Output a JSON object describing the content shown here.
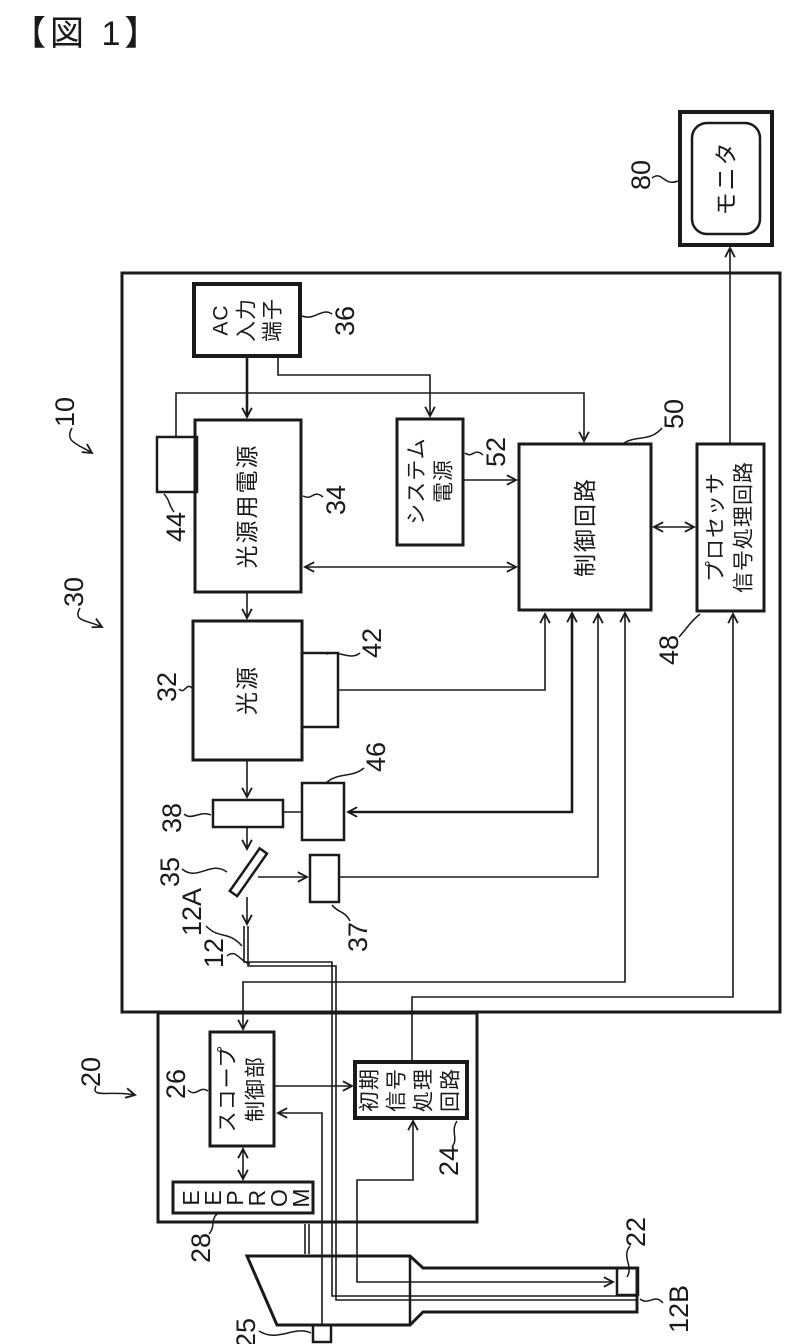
{
  "figure_title": "【図 1】",
  "colors": {
    "ink": "#1a1a1a",
    "background": "#ffffff"
  },
  "blocks": {
    "monitor": {
      "label": "モニタ",
      "ref": "80"
    },
    "ac_input_terminal": {
      "line1": "AC",
      "line2": "入力",
      "line3": "端子",
      "ref": "36"
    },
    "light_source_power_supply": {
      "label": "光源用電源",
      "ref": "34"
    },
    "power_inlet": {
      "ref": "44"
    },
    "system_power_supply": {
      "line1": "システム",
      "line2": "電源",
      "ref": "52"
    },
    "control_circuit": {
      "label": "制御回路",
      "ref": "50"
    },
    "processor_signal_circuit": {
      "line1": "プロセッサ",
      "line2": "信号処理回路",
      "ref": "48"
    },
    "light_source": {
      "label": "光源",
      "ref": "32"
    },
    "sensor_42": {
      "ref": "42"
    },
    "filter_38": {
      "ref": "38"
    },
    "diaphragm_46": {
      "ref": "46"
    },
    "mirror_35": {
      "ref": "35"
    },
    "detector_37": {
      "ref": "37"
    },
    "scope_controller": {
      "line1": "スコープ",
      "line2": "制御部",
      "ref": "26"
    },
    "eeprom": {
      "l1": "E",
      "l2": "E",
      "l3": "P",
      "l4": "R",
      "l5": "O",
      "l6": "M",
      "ref": "28"
    },
    "initial_signal_circuit": {
      "line1": "初期",
      "line2": "信号",
      "line3": "処理",
      "line4": "回路",
      "ref": "24"
    },
    "imaging_tip": {
      "ref": "22"
    },
    "scope_switch": {
      "ref": "25"
    }
  },
  "refs": {
    "processor_unit": "10",
    "light_source_unit": "30",
    "scope_unit": "20",
    "light_guide": "12",
    "light_guide_a": "12A",
    "light_guide_b": "12B"
  }
}
